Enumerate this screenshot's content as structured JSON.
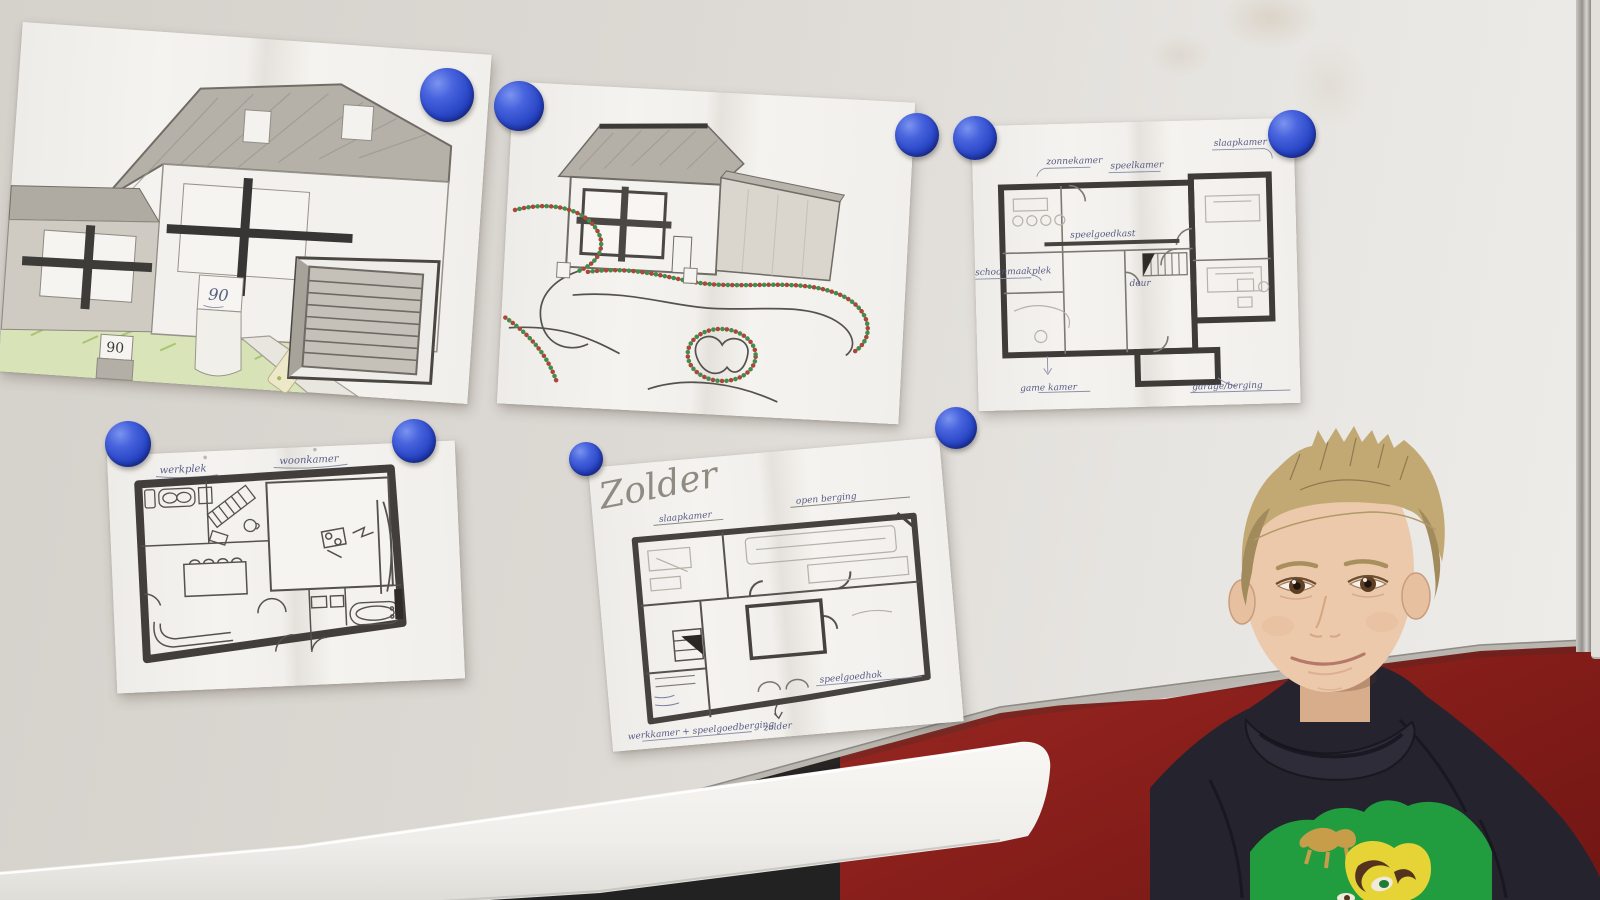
{
  "scene": {
    "description": "Boy standing beside a classroom whiteboard that displays five children's drawings - two house sketches and three hand-drawn floor plans - held up by round blue magnets, with a dark red wall below",
    "magnet_count": 9
  },
  "colors": {
    "magnet_blue": "#2946c6",
    "red_wall": "#8c201c",
    "whiteboard": "#ddd9d4",
    "paper": "#f2f0ec",
    "hoodie": "#24232e",
    "graphic_green": "#219c3f",
    "graphic_yellow": "#e6d335"
  },
  "papers": {
    "house_front": {
      "door_sign": "90",
      "lawn_sign": "90"
    },
    "plan_ground": {
      "labels": {
        "top_left": "zonnekamer",
        "top_mid": "speelkamer",
        "top_right": "slaapkamer",
        "cabinet": "speelgoedkast",
        "door": "deur",
        "left": "schoonmaakplek",
        "bottom_left": "game kamer",
        "bottom_right": "garage/berging"
      }
    },
    "plan_living": {
      "labels": {
        "left": "werkplek",
        "right": "woonkamer"
      }
    },
    "plan_attic": {
      "title": "Zolder",
      "labels": {
        "top_left": "slaapkamer",
        "top_right": "open berging",
        "bottom_left": "werkkamer + speelgoedberging",
        "bottom_mid": "zolder",
        "bottom_right": "speelgoedhok"
      }
    }
  }
}
